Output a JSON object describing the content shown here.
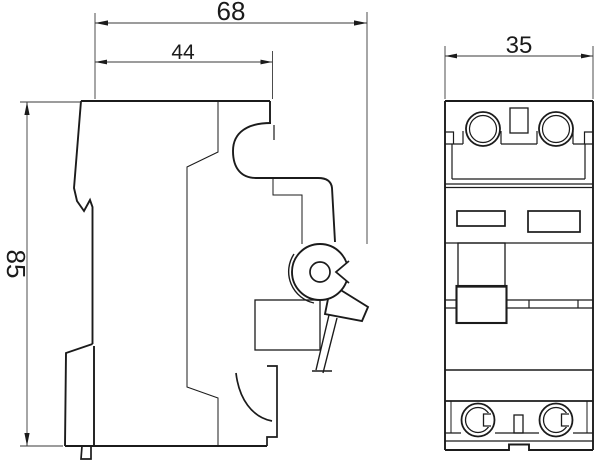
{
  "page": {
    "background": "#ffffff",
    "line_color": "#1b1b1b"
  },
  "drawing": {
    "subject": "dimensioned two-view outline drawing of a DIN-rail circuit breaker",
    "dims": {
      "overall_depth_mm": "68",
      "housing_depth_mm": "44",
      "module_width_mm": "35",
      "height_mm": "85"
    }
  }
}
